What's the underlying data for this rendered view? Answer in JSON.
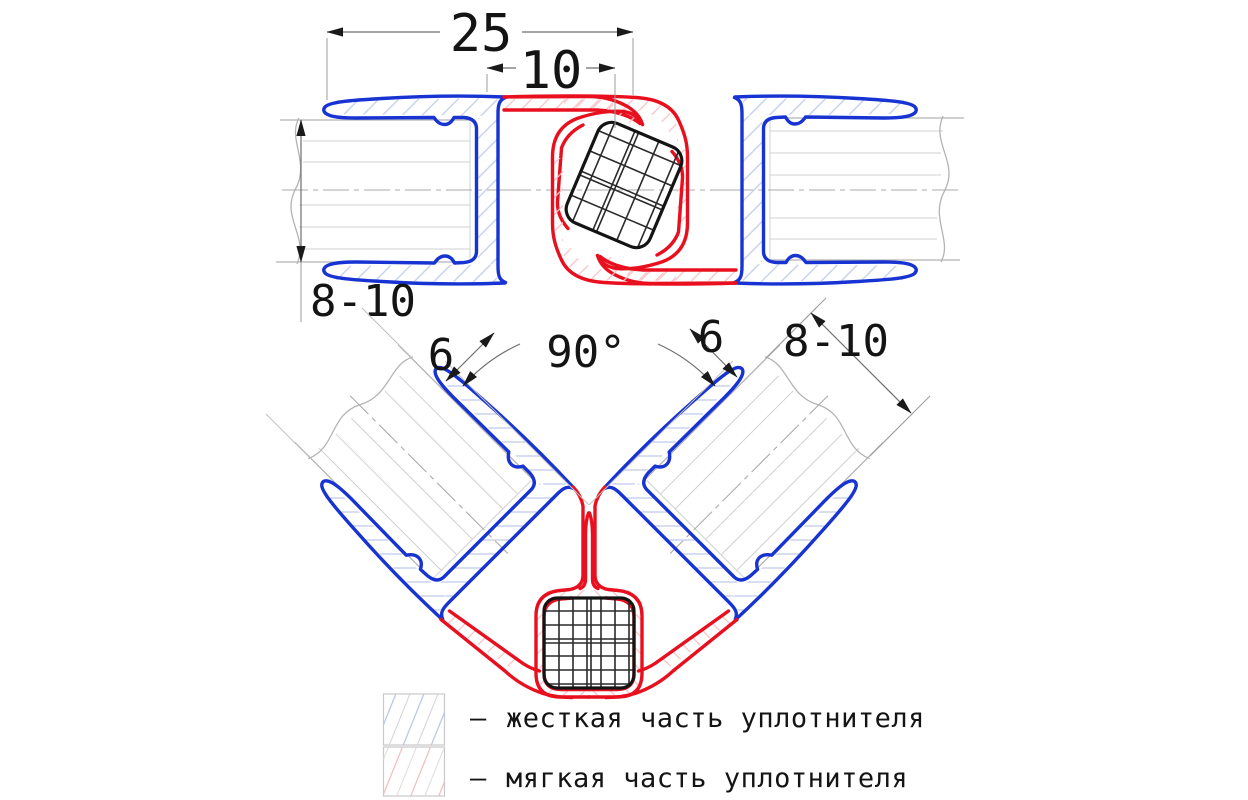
{
  "dimensions": {
    "overall_width": "25",
    "soft_zone_width": "10",
    "glass_thickness_left": "8-10",
    "seal_lip_left": "6",
    "angle": "90°",
    "seal_lip_right": "6",
    "glass_thickness_right": "8-10"
  },
  "legend": {
    "items": [
      {
        "dash": "–",
        "label": "жесткая часть уплотнителя"
      },
      {
        "dash": "–",
        "label": "мягкая часть уплотнителя"
      }
    ]
  },
  "colors": {
    "rigid_part": "#1733d2",
    "soft_part": "#e8101e",
    "magnet_outline": "#141414",
    "hatch_rigid": "#c3cdea",
    "hatch_soft": "#f6c3c8",
    "glass_line": "#b3b3b3",
    "dimension_line": "#6e6e6e"
  }
}
